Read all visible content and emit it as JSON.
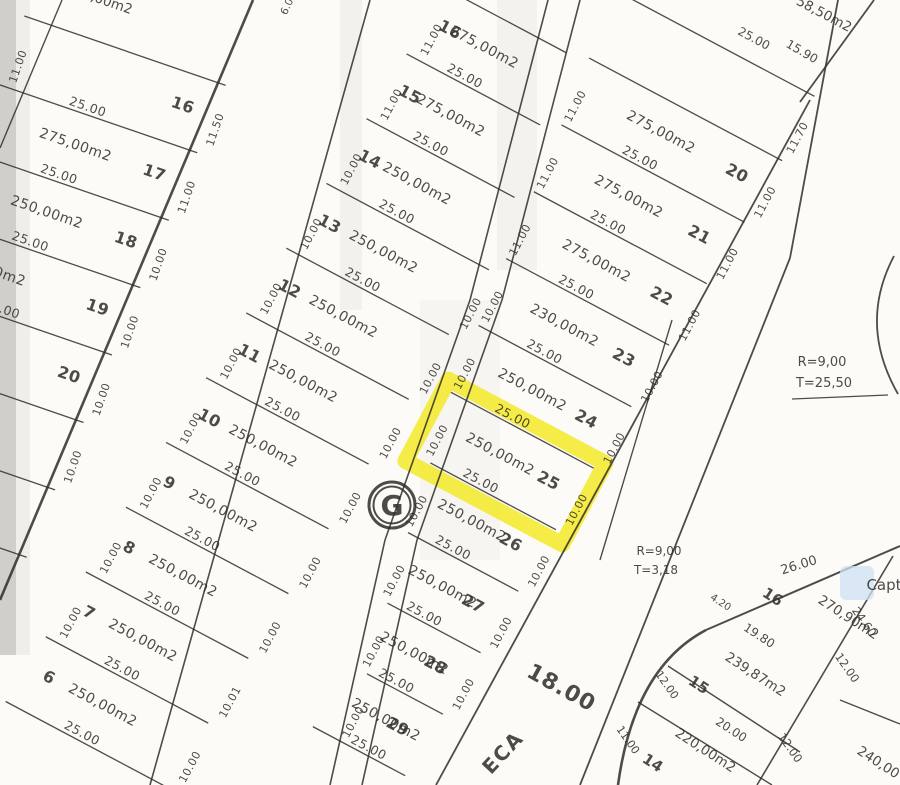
{
  "map": {
    "title_hidden": "",
    "ink_color": "#2e2d2a",
    "highlight_color": "#f3e81c",
    "paper_color": "#fcfbf8",
    "bands": [
      {
        "name": "band-west",
        "angle": 19,
        "origin": [
          30,
          18
        ],
        "strip_w": 73,
        "shear": -5.5,
        "bound": [
          253,
          0,
          -0.4217
        ],
        "lmax": 230,
        "num_side": "right",
        "lots": [
          {
            "num": "16",
            "area": "",
            "len": "25.00",
            "lf": "11.00",
            "rf": "11.50"
          },
          {
            "num": "17",
            "area": "275,00m2",
            "len": "25.00",
            "lf": "",
            "rf": "11.00"
          },
          {
            "num": "18",
            "area": "250,00m2",
            "len": "25.00",
            "lf": "",
            "rf": "10.00"
          },
          {
            "num": "19",
            "area": "250,00m2",
            "len": "25.00",
            "lf": "",
            "rf": "10.00",
            "adx": -30
          },
          {
            "num": "20",
            "area": "",
            "len": "",
            "lf": "",
            "rf": "10.00"
          },
          {
            "num": "",
            "area": "",
            "len": "",
            "lf": "",
            "rf": "10.00"
          },
          {
            "num": "",
            "area": "250,00m2",
            "len": "25.00",
            "lf": "",
            "rf": ""
          }
        ]
      },
      {
        "name": "band-central",
        "angle": 28,
        "origin": [
          452,
          -8
        ],
        "strip_w": 76,
        "shear": -5,
        "bound": [
          576,
          0,
          -0.354
        ],
        "lmax": 170,
        "num_side": "left",
        "lots": [
          {
            "num": "16",
            "area": "275,00m2",
            "len": "25.00",
            "lf": "11.00",
            "rf": ""
          },
          {
            "num": "15",
            "area": "275,00m2",
            "len": "25.00",
            "lf": "11.00",
            "rf": ""
          },
          {
            "num": "14",
            "area": "250,00m2",
            "len": "25.00",
            "lf": "10.00",
            "rf": ""
          },
          {
            "num": "13",
            "area": "250,00m2",
            "len": "25.00",
            "lf": "10.00",
            "rf": "10.00"
          },
          {
            "num": "12",
            "area": "250,00m2",
            "len": "25.00",
            "lf": "10.00",
            "rf": "10.00"
          },
          {
            "num": "11",
            "area": "250,00m2",
            "len": "25.00",
            "lf": "10.00",
            "rf": "10.00"
          },
          {
            "num": "10",
            "area": "250,00m2",
            "len": "25.00",
            "lf": "10.00",
            "rf": "10.00"
          },
          {
            "num": "9",
            "area": "250,00m2",
            "len": "25.00",
            "lf": "10.00",
            "rf": "10.00"
          },
          {
            "num": "8",
            "area": "250,00m2",
            "len": "25.00",
            "lf": "10.00",
            "rf": "10.00"
          },
          {
            "num": "7",
            "area": "250,00m2",
            "len": "25.00",
            "lf": "10.00",
            "rf": "10.01"
          },
          {
            "num": "6",
            "area": "250,00m2",
            "len": "25.00",
            "lf": "",
            "rf": "10.00"
          }
        ]
      },
      {
        "name": "band-east",
        "angle": 28,
        "origin": [
          622,
          -6
        ],
        "strip_w": 72,
        "shear": 7,
        "bound": [
          810,
          100,
          -0.613
        ],
        "lmax": 210,
        "num_side": "right",
        "lots": [
          {
            "num": "",
            "area": "",
            "len": "",
            "lf": "",
            "rf": "11.70"
          },
          {
            "num": "20",
            "area": "275,00m2",
            "len": "25.00",
            "lf": "11.00",
            "rf": "11.00"
          },
          {
            "num": "21",
            "area": "275,00m2",
            "len": "25.00",
            "lf": "11.00",
            "rf": "11.00"
          },
          {
            "num": "22",
            "area": "275,00m2",
            "len": "25.00",
            "lf": "11.00",
            "rf": "11.00"
          },
          {
            "num": "23",
            "area": "230,00m2",
            "len": "25.00",
            "lf": "10.00",
            "rf": "10.00"
          },
          {
            "num": "24",
            "area": "250,00m2",
            "len": "25.00",
            "lf": "10.00",
            "rf": "10.00"
          },
          {
            "num": "25",
            "area": "250,00m2",
            "len": "25.00",
            "lf": "10.00",
            "rf": "10.00",
            "hl": true
          },
          {
            "num": "26",
            "area": "250,00m2",
            "len": "25.00",
            "lf": "10.00",
            "rf": "10.00",
            "dx": 8
          },
          {
            "num": "27",
            "area": "250,00m2",
            "len": "25.00",
            "lf": "10.00",
            "rf": "10.00",
            "dx": 14
          },
          {
            "num": "28",
            "area": "250,00m2",
            "len": "25.00",
            "lf": "10.00",
            "rf": "10.00",
            "dx": 22
          },
          {
            "num": "29",
            "area": "250,00m2",
            "len": "25.00",
            "lf": "10.00",
            "rf": "",
            "dx": 30
          }
        ]
      }
    ],
    "streets": [
      {
        "name": "street-1-left-edge",
        "pts": [
          [
            253,
            0
          ],
          [
            0,
            600
          ]
        ],
        "w": 2.6
      },
      {
        "name": "street-1-right-edge",
        "pts": [
          [
            370,
            0
          ],
          [
            150,
            785
          ]
        ],
        "w": 1.6
      },
      {
        "name": "street-2-left-edge",
        "pts": [
          [
            548,
            0
          ],
          [
            470,
            300
          ],
          [
            385,
            540
          ],
          [
            330,
            785
          ]
        ],
        "w": 1.6
      },
      {
        "name": "street-2-right-edge",
        "pts": [
          [
            580,
            0
          ],
          [
            502,
            300
          ],
          [
            417,
            540
          ],
          [
            362,
            785
          ]
        ],
        "w": 1.6
      },
      {
        "name": "street-3-left-edge",
        "pts": [
          [
            810,
            100
          ],
          [
            436,
            785
          ]
        ],
        "w": 1.8
      },
      {
        "name": "street-3-right-edge",
        "pts": [
          [
            790,
            258
          ],
          [
            580,
            785
          ]
        ],
        "w": 1.8
      },
      {
        "name": "street-3-right-edge-top",
        "pts": [
          [
            838,
            0
          ],
          [
            790,
            258
          ]
        ],
        "w": 1.8
      },
      {
        "name": "street-3-fork-line",
        "pts": [
          [
            672,
            320
          ],
          [
            600,
            560
          ]
        ],
        "w": 1.4
      },
      {
        "name": "corner-chamfer-line",
        "pts": [
          [
            800,
            102
          ],
          [
            874,
            0
          ]
        ],
        "w": 1.8
      },
      {
        "name": "west-edge-line",
        "pts": [
          [
            0,
            148
          ],
          [
            62,
            0
          ]
        ],
        "w": 1.4
      },
      {
        "name": "block-d-top-edge",
        "pts": [
          [
            706,
            630
          ],
          [
            900,
            546
          ]
        ],
        "w": 2.0
      },
      {
        "name": "block-d-division-1",
        "pts": [
          [
            668,
            666
          ],
          [
            800,
            752
          ]
        ],
        "w": 1.4
      },
      {
        "name": "block-d-division-2",
        "pts": [
          [
            638,
            702
          ],
          [
            772,
            785
          ]
        ],
        "w": 1.4
      },
      {
        "name": "block-d-rear-line",
        "pts": [
          [
            893,
            556
          ],
          [
            757,
            785
          ]
        ],
        "w": 1.6
      },
      {
        "name": "block-d-col2-division",
        "pts": [
          [
            840,
            700
          ],
          [
            900,
            724
          ]
        ],
        "w": 1.4
      },
      {
        "name": "curve-leader-line",
        "pts": [
          [
            792,
            399
          ],
          [
            888,
            395
          ]
        ],
        "w": 1.2
      }
    ],
    "curves": [
      {
        "name": "culdesac-arc",
        "d": "M 894,256 Q 858,324 898,394",
        "w": 1.8
      },
      {
        "name": "block-d-corner-curve",
        "d": "M 618,785 Q 634,668 706,630",
        "w": 2.6
      }
    ],
    "labels": [
      {
        "name": "clipped-area-top-west",
        "text": "275,00m2",
        "x": 98,
        "y": 3,
        "r": 19,
        "s": 13.5
      },
      {
        "name": "corner-lot-area",
        "text": "58,50m2",
        "x": 822,
        "y": 18,
        "r": 28,
        "s": 13.5
      },
      {
        "name": "corner-lot-length",
        "text": "25.00",
        "x": 752,
        "y": 42,
        "r": 28,
        "s": 12
      },
      {
        "name": "corner-lot-front",
        "text": "15.90",
        "x": 800,
        "y": 55,
        "r": 30,
        "s": 12
      },
      {
        "name": "street-width-fragment",
        "text": "6.0",
        "x": 290,
        "y": 8,
        "r": -65,
        "s": 10.5
      },
      {
        "name": "curve-radius-ne",
        "text": "R=9,00",
        "x": 822,
        "y": 366,
        "r": 0,
        "s": 13
      },
      {
        "name": "curve-tangent-ne",
        "text": "T=25,50",
        "x": 824,
        "y": 387,
        "r": 0,
        "s": 13
      },
      {
        "name": "curve-radius-s",
        "text": "R=9,00",
        "x": 659,
        "y": 555,
        "r": 0,
        "s": 12
      },
      {
        "name": "curve-tangent-s",
        "text": "T=3,18",
        "x": 656,
        "y": 574,
        "r": 0,
        "s": 12
      },
      {
        "name": "street-width-18",
        "text": "18.00",
        "x": 558,
        "y": 694,
        "r": 29,
        "s": 22,
        "b": true,
        "ls": 1
      },
      {
        "name": "street-name-eca",
        "text": "ECA",
        "x": 508,
        "y": 757,
        "r": -47,
        "s": 20,
        "b": true,
        "ls": 2
      },
      {
        "name": "block-d-street-len",
        "text": "26.00",
        "x": 800,
        "y": 569,
        "r": -17,
        "s": 13
      },
      {
        "name": "block-d-lot16-num",
        "text": "16",
        "x": 770,
        "y": 601,
        "r": 33,
        "s": 15,
        "b": true
      },
      {
        "name": "block-d-lot16-seg",
        "text": "4.20",
        "x": 719,
        "y": 605,
        "r": 33,
        "s": 10
      },
      {
        "name": "block-d-lot16-len",
        "text": "19.80",
        "x": 757,
        "y": 639,
        "r": 33,
        "s": 12
      },
      {
        "name": "block-d-lot16-area",
        "text": "270,90m2",
        "x": 846,
        "y": 621,
        "r": 33,
        "s": 13.5
      },
      {
        "name": "block-d-dim-2460",
        "text": "24.60",
        "x": 861,
        "y": 624,
        "r": 55,
        "s": 11.5
      },
      {
        "name": "block-d-lot15-num",
        "text": "15",
        "x": 696,
        "y": 689,
        "r": 33,
        "s": 15,
        "b": true
      },
      {
        "name": "block-d-lot15-area",
        "text": "239,87m2",
        "x": 753,
        "y": 678,
        "r": 33,
        "s": 13.5
      },
      {
        "name": "block-d-lot15-len",
        "text": "20.00",
        "x": 729,
        "y": 733,
        "r": 33,
        "s": 12
      },
      {
        "name": "block-d-dim-1200a",
        "text": "12.00",
        "x": 844,
        "y": 670,
        "r": 55,
        "s": 11.5
      },
      {
        "name": "block-d-dim-1200b",
        "text": "12.00",
        "x": 787,
        "y": 750,
        "r": 55,
        "s": 11.5
      },
      {
        "name": "block-d-dim-1200c",
        "text": "12.00",
        "x": 664,
        "y": 687,
        "r": 55,
        "s": 11
      },
      {
        "name": "block-d-lot14-num",
        "text": "14",
        "x": 650,
        "y": 767,
        "r": 33,
        "s": 15,
        "b": true
      },
      {
        "name": "block-d-lot14-area",
        "text": "220,00m2",
        "x": 703,
        "y": 754,
        "r": 33,
        "s": 13.5
      },
      {
        "name": "block-d-lot14-front",
        "text": "11.00",
        "x": 625,
        "y": 742,
        "r": 55,
        "s": 11
      },
      {
        "name": "block-d-lot13-area",
        "text": "240,00",
        "x": 876,
        "y": 766,
        "r": 33,
        "s": 13.5
      }
    ],
    "g_marker": {
      "name": "block-letter-marker",
      "text": "G",
      "x": 392,
      "y": 505
    },
    "watermark": {
      "name": "capture-watermark",
      "text": "Capt",
      "x": 884,
      "y": 590,
      "box": [
        840,
        566,
        34,
        34
      ],
      "box_color": "#cfe2f4",
      "text_color": "#b4c9de"
    },
    "scan_artifacts": [
      {
        "name": "scan-edge-dark",
        "x": 0,
        "y": 0,
        "w": 16,
        "h": 655,
        "c": "#d0cfcb",
        "o": 1
      },
      {
        "name": "scan-edge-light",
        "x": 16,
        "y": 0,
        "w": 14,
        "h": 655,
        "c": "#e9e8e4",
        "o": 0.7
      },
      {
        "name": "scan-crease-1",
        "x": 340,
        "y": 0,
        "w": 22,
        "h": 310,
        "c": "#f1f0ec",
        "o": 0.9
      },
      {
        "name": "scan-crease-2",
        "x": 497,
        "y": 0,
        "w": 40,
        "h": 270,
        "c": "#f2f1ed",
        "o": 0.9
      },
      {
        "name": "scan-crease-3",
        "x": 420,
        "y": 300,
        "w": 80,
        "h": 260,
        "c": "#f3f2ee",
        "o": 0.6
      }
    ]
  }
}
